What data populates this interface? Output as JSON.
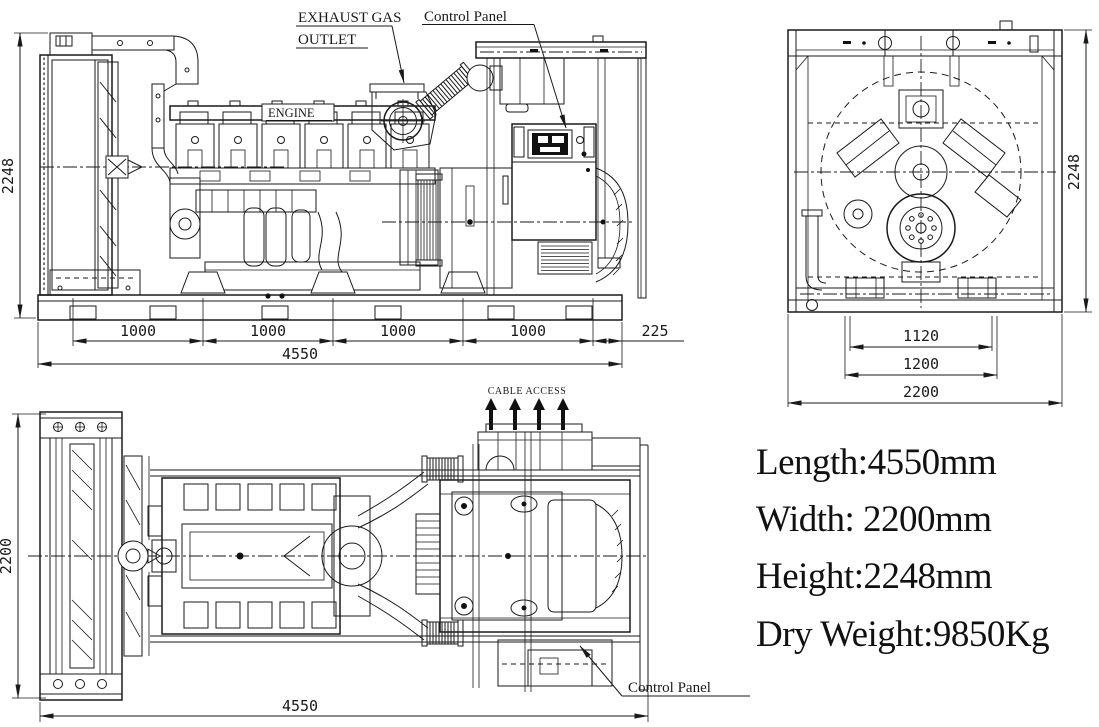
{
  "title": "Generator set general arrangement drawing",
  "colors": {
    "line": "#1a1a1a",
    "background": "#ffffff",
    "fill": "#111111"
  },
  "labels": {
    "exhaust_line1": "EXHAUST GAS",
    "exhaust_line2": "OUTLET",
    "control_panel_top": "Control Panel",
    "engine": "ENGINE",
    "cable_access": "CABLE ACCESS",
    "control_panel_bottom": "Control Panel"
  },
  "dimensions": {
    "side": {
      "height": "2248",
      "chain": [
        "1000",
        "1000",
        "1000",
        "1000"
      ],
      "offset": "225",
      "total": "4550"
    },
    "front": {
      "height": "2248",
      "inner_width": "1120",
      "base_width": "1200",
      "overall_width": "2200"
    },
    "plan": {
      "width": "2200",
      "length": "4550"
    }
  },
  "specs": {
    "length": "Length:4550mm",
    "width": "Width: 2200mm",
    "height": "Height:2248mm",
    "weight": "Dry Weight:9850Kg"
  }
}
